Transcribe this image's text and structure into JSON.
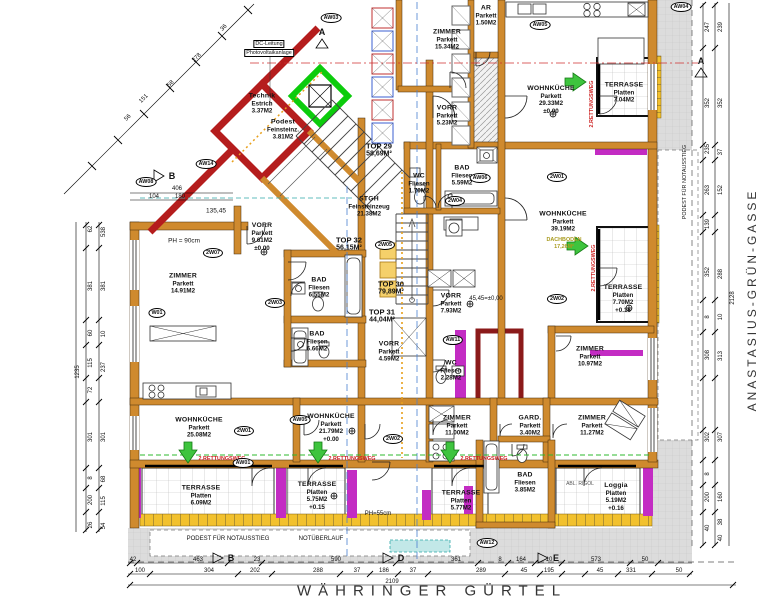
{
  "streets": {
    "bottom": "WÄHRINGER GÜRTEL",
    "right": "ANASTASIUS-GRÜN-GASSE"
  },
  "tops": [
    {
      "id": "TOP 29",
      "area": "58,69M²"
    },
    {
      "id": "TOP 30",
      "area": "79,89M²"
    },
    {
      "id": "TOP 31",
      "area": "44,04M²"
    },
    {
      "id": "TOP 32",
      "area": "56,15M²"
    }
  ],
  "rooms": [
    {
      "name": "ZIMMER",
      "material": "Parkett",
      "area": "15.34M2",
      "level": ""
    },
    {
      "name": "AR",
      "material": "Parkett",
      "area": "1.50M2",
      "level": ""
    },
    {
      "name": "VORR",
      "material": "Parkett",
      "area": "5.23M2",
      "level": ""
    },
    {
      "name": "WOHNKÜCHE",
      "material": "Parkett",
      "area": "29.33M2",
      "level": "±0.00"
    },
    {
      "name": "TERRASSE",
      "material": "Platten",
      "area": "7.04M2",
      "level": ""
    },
    {
      "name": "BAD",
      "material": "Fliesen",
      "area": "5.59M2",
      "level": ""
    },
    {
      "name": "WC",
      "material": "Fliesen",
      "area": "1.70M2",
      "level": ""
    },
    {
      "name": "WOHNKÜCHE",
      "material": "Parkett",
      "area": "39.19M2",
      "level": ""
    },
    {
      "name": "TERRASSE",
      "material": "Platten",
      "area": "7.70M2",
      "level": "+0.16"
    },
    {
      "name": "ZIMMER",
      "material": "Parkett",
      "area": "10.97M2",
      "level": ""
    },
    {
      "name": "ZIMMER",
      "material": "Parkett",
      "area": "14.91M2",
      "level": ""
    },
    {
      "name": "VORR",
      "material": "Parkett",
      "area": "9.61M2",
      "level": "±0.00"
    },
    {
      "name": "BAD",
      "material": "Fliesen",
      "area": "6.55M2",
      "level": ""
    },
    {
      "name": "BAD",
      "material": "Fliesen",
      "area": "6.66M2",
      "level": ""
    },
    {
      "name": "VORR",
      "material": "Parkett",
      "area": "4.59M2",
      "level": ""
    },
    {
      "name": "VORR",
      "material": "Parkett",
      "area": "7.93M2",
      "level": ""
    },
    {
      "name": "WC",
      "material": "Fliesen",
      "area": "2.28M2",
      "level": ""
    },
    {
      "name": "STGH",
      "material": "Feinsteinzeug",
      "area": "21.38M2",
      "level": ""
    },
    {
      "name": "Technik",
      "material": "Estrich",
      "area": "3.37M2",
      "level": ""
    },
    {
      "name": "Podest",
      "material": "Feinsteinz.",
      "area": "3.81M2",
      "level": ""
    },
    {
      "name": "WOHNKÜCHE",
      "material": "Parkett",
      "area": "25.08M2",
      "level": ""
    },
    {
      "name": "WOHNKÜCHE",
      "material": "Parkett",
      "area": "21.79M2",
      "level": "+0.00"
    },
    {
      "name": "ZIMMER",
      "material": "Parkett",
      "area": "11.00M2",
      "level": ""
    },
    {
      "name": "GARD.",
      "material": "Parkett",
      "area": "3.40M2",
      "level": ""
    },
    {
      "name": "ZIMMER",
      "material": "Parkett",
      "area": "11.27M2",
      "level": ""
    },
    {
      "name": "BAD",
      "material": "Fliesen",
      "area": "3.85M2",
      "level": ""
    },
    {
      "name": "TERRASSE",
      "material": "Platten",
      "area": "6.09M2",
      "level": ""
    },
    {
      "name": "TERRASSE",
      "material": "Platten",
      "area": "5.75M2",
      "level": "+0.15"
    },
    {
      "name": "TERRASSE",
      "material": "Platten",
      "area": "5.77M2",
      "level": ""
    },
    {
      "name": "Loggia",
      "material": "Platten",
      "area": "5.19M2",
      "level": "+0.16"
    }
  ],
  "tags": [
    "AW03",
    "AW05",
    "AW04",
    "AW08",
    "AW14",
    "2W07",
    "W01",
    "2W03",
    "2W04",
    "AW06",
    "2W01",
    "2W02",
    "2W05",
    "AW11",
    "2W01",
    "AW05",
    "AW01",
    "2W02",
    "AW12"
  ],
  "markers": {
    "a": "A",
    "b": "B",
    "d": "D",
    "e": "E"
  },
  "annotations": {
    "dc1": "DC-Leitung",
    "dc2": "Photovoltaikanlage",
    "podest_bottom": "PODEST FÜR NOTAUSSTIEG",
    "notueberlauf": "NOTÜBERLAUF",
    "podest_right": "PODEST FÜR NOTAUSSTIEG",
    "rettungsweg": "2.RETTUNGSWEG",
    "ph90": "PH = 90cm",
    "ph55": "PH=55cm",
    "niveau": "45,45=±0,00",
    "abl_rigol": "ABL. RIGOL",
    "dach1": "DACHBODEN",
    "dach2": "17,26M²"
  },
  "dims": {
    "bottom_row1": [
      "42",
      "463",
      "23",
      "590",
      "361",
      "8",
      "164",
      "10",
      "573",
      "50"
    ],
    "bottom_row2": [
      "100",
      "304",
      "202",
      "288",
      "37",
      "186",
      "37",
      "289",
      "45",
      "195",
      "45",
      "331",
      "50"
    ],
    "bottom_total": "2109",
    "left_col1": [
      "62",
      "381",
      "60",
      "115",
      "72",
      "301",
      "8",
      "200",
      "26"
    ],
    "left_col2": [
      "538",
      "381",
      "10",
      "237",
      "301",
      "68",
      "115",
      "54"
    ],
    "left_total": "1235",
    "right_col1": [
      "247",
      "352",
      "235",
      "263",
      "139",
      "352",
      "8",
      "308",
      "302",
      "8",
      "200",
      "40"
    ],
    "right_col2": [
      "239",
      "352",
      "37",
      "152",
      "288",
      "10",
      "313",
      "307",
      "160",
      "38",
      "40"
    ],
    "right_total": "2128",
    "diagonal": [
      "56",
      "151",
      "58",
      "278",
      "36"
    ],
    "left_top": [
      "406",
      "104",
      "180",
      "135,45"
    ]
  },
  "colors": {
    "wall": "#cf8a2e",
    "new_wall_red": "#b51d1d",
    "elevator_green": "#0ccc0c",
    "terrace_magenta": "#c32cc3",
    "gold": "#f2c12e",
    "escape_route_green": "#2db82d",
    "escape_text_red": "#cc2222",
    "axis_blue": "#4a7fd0"
  }
}
